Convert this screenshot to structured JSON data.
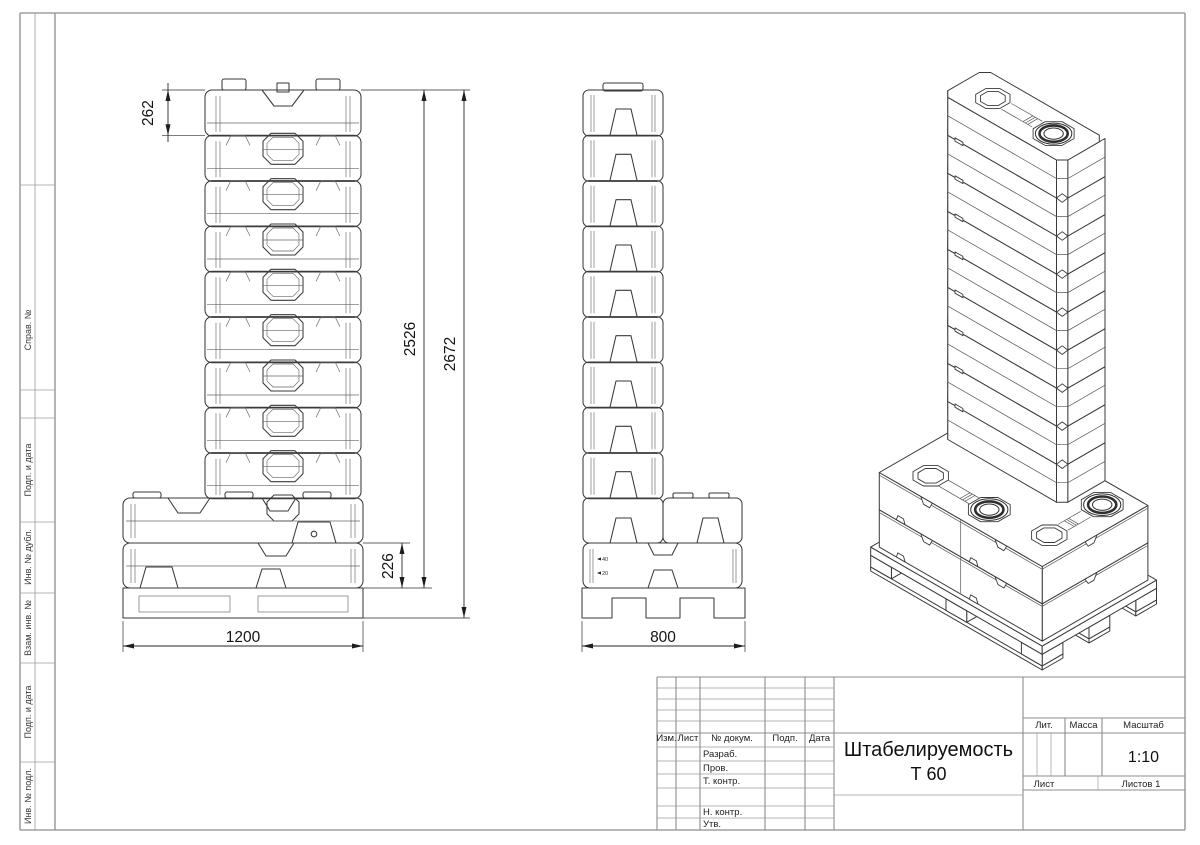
{
  "drawing": {
    "title": {
      "line1": "Штабелируемость",
      "line2": "Т 60"
    },
    "scale": "1:10",
    "stamp": {
      "col_izm": "Изм.",
      "col_list": "Лист",
      "col_dokum": "№ докум.",
      "col_podp": "Подп.",
      "col_data": "Дата",
      "row_razrab": "Разраб.",
      "row_prov": "Пров.",
      "row_tkontr": "Т. контр.",
      "row_nkontr": "Н. контр.",
      "row_utv": "Утв.",
      "lit": "Лит.",
      "massa": "Масса",
      "masshtab": "Масштаб",
      "list": "Лист",
      "listov": "Листов 1"
    },
    "margin_labels": {
      "sprav": "Справ. №",
      "podp1": "Подп. и дата",
      "inv_dubl": "Инв. № дубл.",
      "vzam": "Взам. инв. №",
      "podp2": "Подп. и дата",
      "inv_podl": "Инв. № подл."
    },
    "dimensions": {
      "unit_height": "262",
      "stack_height": "2526",
      "total_height": "2672",
      "flat_tank_height": "226",
      "pallet_length": "1200",
      "pallet_width": "800"
    },
    "stack": {
      "tower_units": 9,
      "flat_layers": 2
    },
    "level_marks": [
      "40",
      "20"
    ]
  }
}
